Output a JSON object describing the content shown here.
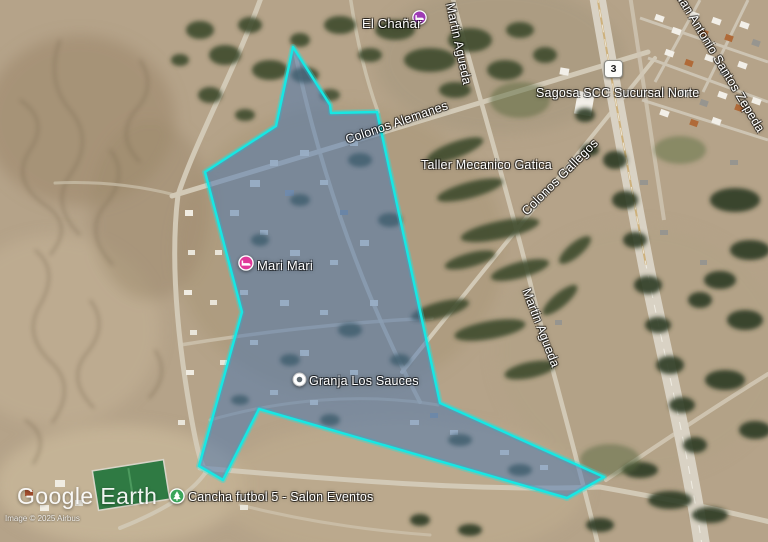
{
  "map": {
    "places": {
      "el_chanar": "El Chañar",
      "sagosa": "Sagosa SCC Sucursal Norte",
      "taller": "Taller Mecanico Gatica",
      "mari_mari": "Mari Mari",
      "granja": "Granja Los Sauces",
      "cancha": "Cancha futbol 5 - Salon Eventos"
    },
    "roads": {
      "colonos_alemanes": "Colonos Alemanes",
      "colonos_gallegos": "Colonos Gallegos",
      "martin_agueda": "Martin Agueda",
      "martin_agueda_top": "Martin Agueda",
      "santos_zepeda": "Juan Antonio Santos Zepeda",
      "route_number": "3"
    },
    "overlay": {
      "polygon_points": "293,47 330,105 331,113 377,112 440,403 604,477 567,498 259,409 223,480 199,466 242,312 205,172 276,126",
      "stroke": "#17e7e3",
      "fill": "rgba(70,115,175,0.5)"
    },
    "pins": {
      "el_chanar_color": "#9d3bb5",
      "mari_mari_color": "#e0399a",
      "granja_color": "#ffffff",
      "granja_dot_color": "#5f6a72",
      "cancha_color": "#3ba55b"
    }
  },
  "branding": {
    "logo": "Google Earth",
    "copyright": "Image © 2025 Airbus"
  }
}
